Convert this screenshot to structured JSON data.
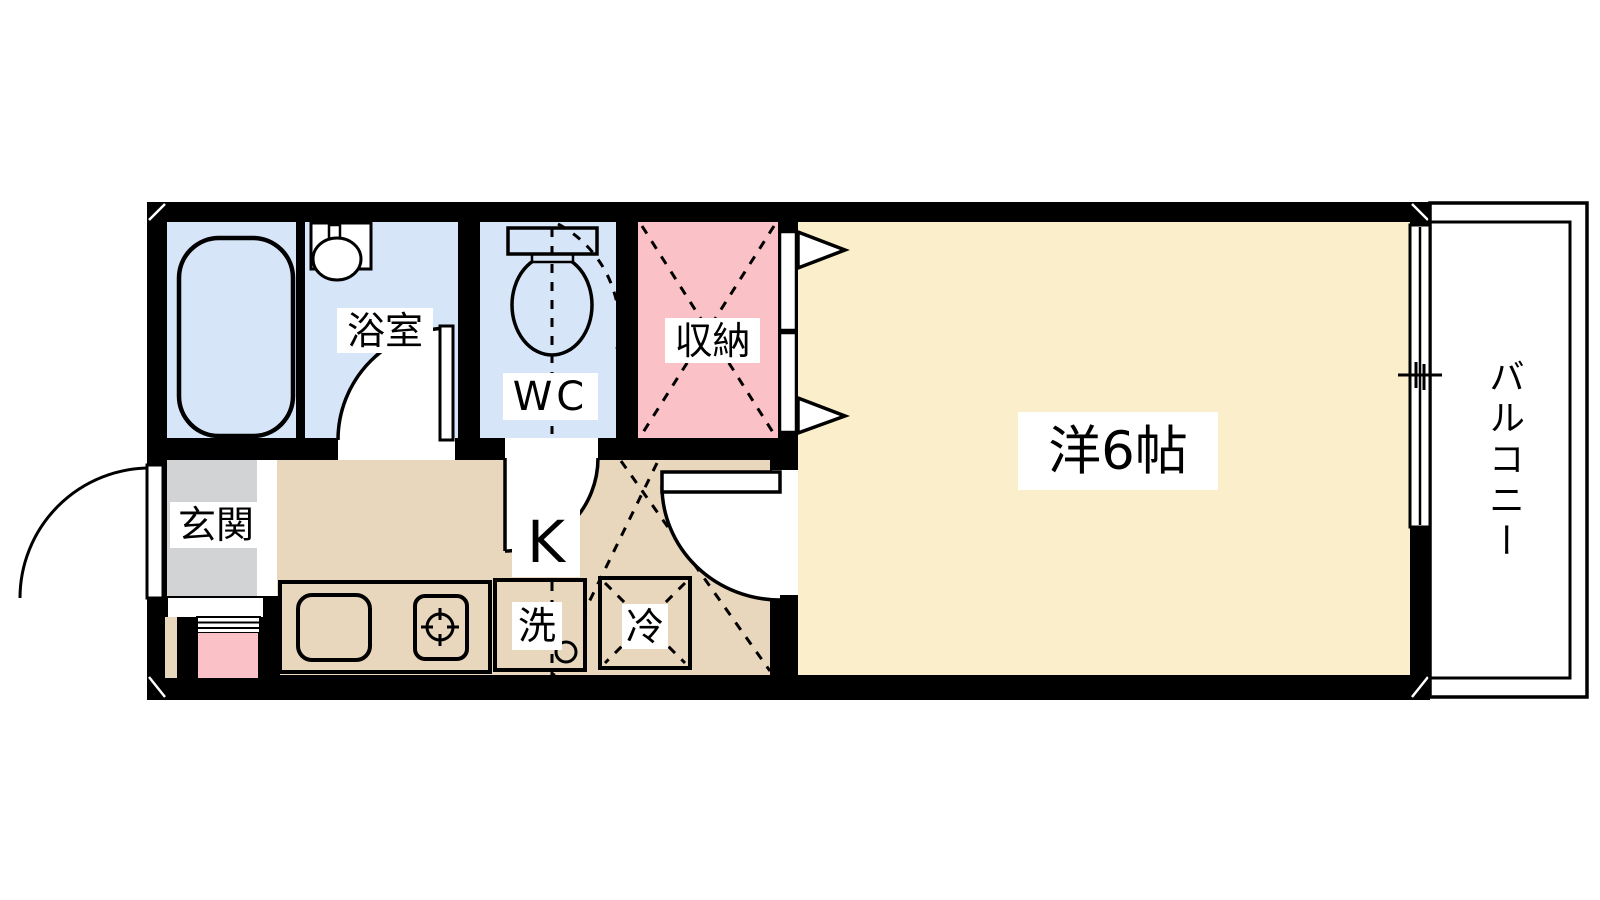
{
  "colors": {
    "wall": "#000000",
    "wet_room_blue": "#d7e5f8",
    "closet_pink": "#fac2c7",
    "main_room_cream": "#fbeecb",
    "kitchen_tan": "#e8d7bd",
    "entrance_gray": "#d2d3d5",
    "background": "#ffffff"
  },
  "rooms": {
    "bathroom": {
      "label": "浴室"
    },
    "toilet_room": {
      "label": "WC"
    },
    "closet": {
      "label": "収納"
    },
    "entrance": {
      "label": "玄関"
    },
    "kitchen": {
      "label": "K"
    },
    "washer": {
      "label": "洗"
    },
    "refrigerator": {
      "label": "冷"
    },
    "main_room": {
      "label": "洋6帖"
    },
    "balcony": {
      "label": "バルコニー"
    }
  }
}
